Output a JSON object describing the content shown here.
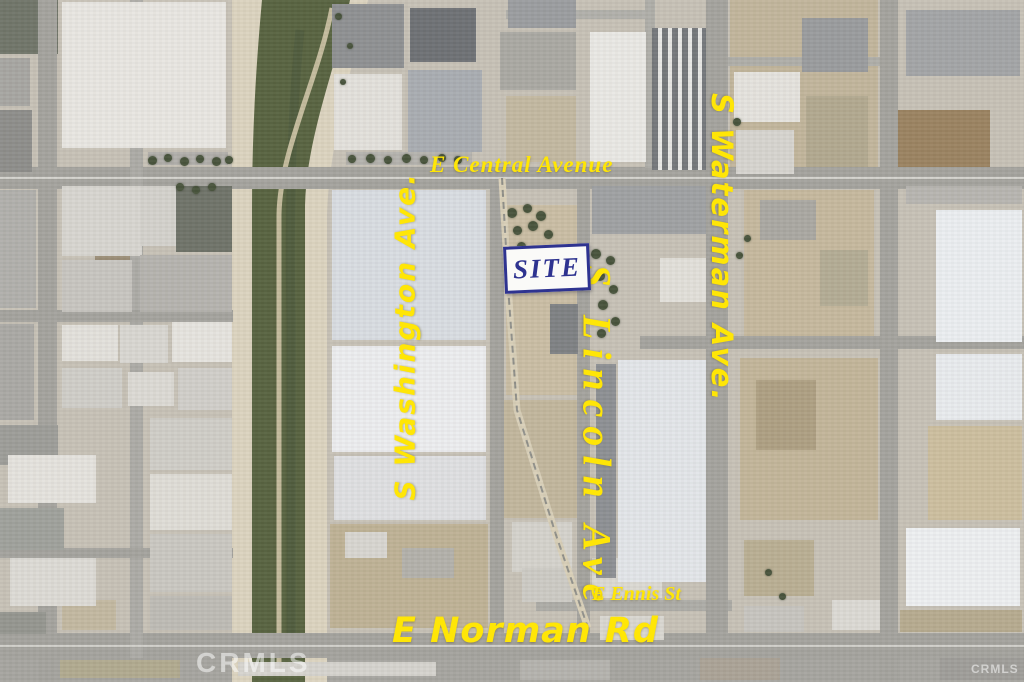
{
  "image": {
    "width": 1024,
    "height": 682,
    "kind": "aerial-satellite-map"
  },
  "labels": {
    "central": {
      "text": "E Central Avenue"
    },
    "washington": {
      "text": "S Washington Ave."
    },
    "lincoln": {
      "text": "S Lincoln Ave"
    },
    "waterman": {
      "text": "S Waterman Ave."
    },
    "ennis": {
      "text": "E Ennis St"
    },
    "norman": {
      "text": "E Norman Rd"
    },
    "site": {
      "text": "SITE"
    }
  },
  "watermarks": {
    "left": "CRMLS",
    "right": "CRMLS"
  },
  "colors": {
    "street_label": "#FFE606",
    "site_label": "#2E3390",
    "site_box_bg": "#FAFAF8",
    "watermark": "rgba(255,255,255,0.52)",
    "base_ground": "#c6c1b6",
    "road": "#a3a29d",
    "channel_sand": "#dbd3bf",
    "channel_green": "#57623f",
    "railroad": "#d8cfb8"
  },
  "map": {
    "patches": [
      [
        0,
        0,
        58,
        54,
        "#6f7468"
      ],
      [
        730,
        0,
        148,
        178,
        "#c1b59b"
      ],
      [
        506,
        96,
        70,
        66,
        "#c2b8a0"
      ],
      [
        506,
        205,
        76,
        190,
        "#c9bda3"
      ],
      [
        504,
        400,
        76,
        118,
        "#c1b69c"
      ],
      [
        330,
        524,
        158,
        104,
        "#beb195"
      ],
      [
        884,
        110,
        106,
        66,
        "#9a8260"
      ],
      [
        744,
        190,
        130,
        146,
        "#c5b89d"
      ],
      [
        740,
        358,
        138,
        162,
        "#c2b599"
      ],
      [
        756,
        380,
        60,
        70,
        "#ad9f82"
      ],
      [
        928,
        426,
        94,
        94,
        "#ccbe9e"
      ],
      [
        900,
        610,
        122,
        22,
        "#b6aa8f"
      ],
      [
        0,
        658,
        1024,
        24,
        "#a5a49f"
      ],
      [
        60,
        660,
        120,
        18,
        "#b0a98f"
      ],
      [
        62,
        600,
        54,
        30,
        "#c2b8a0"
      ],
      [
        744,
        540,
        70,
        56,
        "#b9ae93"
      ],
      [
        806,
        96,
        62,
        72,
        "#b1a88f"
      ],
      [
        820,
        250,
        48,
        56,
        "#b3ab94"
      ],
      [
        95,
        186,
        40,
        126,
        "#9a8d76"
      ]
    ],
    "roads": [
      [
        0,
        167,
        1024,
        22
      ],
      [
        0,
        633,
        1024,
        25
      ],
      [
        536,
        600,
        196,
        11,
        "#acaba6"
      ],
      [
        38,
        0,
        19,
        682
      ],
      [
        130,
        0,
        13,
        658,
        "#abaaa5"
      ],
      [
        490,
        167,
        14,
        478
      ],
      [
        577,
        167,
        13,
        478
      ],
      [
        706,
        0,
        22,
        682
      ],
      [
        880,
        0,
        18,
        682
      ],
      [
        645,
        0,
        10,
        168,
        "#aeada8"
      ],
      [
        506,
        10,
        140,
        9,
        "#b0afaa"
      ],
      [
        728,
        57,
        152,
        9,
        "#aeada8"
      ],
      [
        0,
        310,
        233,
        12
      ],
      [
        0,
        548,
        233,
        10
      ],
      [
        640,
        336,
        384,
        13
      ],
      [
        0,
        177,
        1024,
        2,
        "#d4d3ce"
      ],
      [
        0,
        645,
        1024,
        2,
        "#d0cfca"
      ]
    ],
    "buildings": [
      [
        62,
        2,
        164,
        146,
        "#e8e6e1"
      ],
      [
        148,
        152,
        80,
        13,
        "#b0aeaa"
      ],
      [
        0,
        58,
        30,
        48,
        "#a6a5a1"
      ],
      [
        0,
        110,
        32,
        62,
        "#8d8d8a"
      ],
      [
        0,
        190,
        36,
        118,
        "#b0afab"
      ],
      [
        62,
        186,
        80,
        70,
        "#d7d5d0"
      ],
      [
        140,
        186,
        40,
        60,
        "#d3d1cc"
      ],
      [
        176,
        186,
        56,
        66,
        "#6e7268"
      ],
      [
        62,
        260,
        70,
        52,
        "#c7c5c0"
      ],
      [
        140,
        255,
        92,
        57,
        "#b5b3ae"
      ],
      [
        62,
        325,
        56,
        36,
        "#e2e0db"
      ],
      [
        120,
        325,
        48,
        38,
        "#d8d6d1"
      ],
      [
        172,
        322,
        60,
        40,
        "#e5e3de"
      ],
      [
        62,
        368,
        60,
        40,
        "#cfcdc8"
      ],
      [
        128,
        372,
        46,
        34,
        "#dbd9d4"
      ],
      [
        178,
        368,
        54,
        42,
        "#d0cec9"
      ],
      [
        0,
        324,
        34,
        96,
        "#a9a8a4"
      ],
      [
        0,
        425,
        58,
        40,
        "#9c9c98"
      ],
      [
        8,
        455,
        88,
        48,
        "#e4e2dd"
      ],
      [
        0,
        508,
        64,
        42,
        "#9ea09b"
      ],
      [
        10,
        558,
        86,
        48,
        "#dcdad5"
      ],
      [
        0,
        612,
        46,
        22,
        "#94958f"
      ],
      [
        150,
        418,
        82,
        52,
        "#cfcdc7"
      ],
      [
        150,
        474,
        82,
        56,
        "#dedcd6"
      ],
      [
        150,
        534,
        82,
        58,
        "#c9c7c1"
      ],
      [
        150,
        596,
        82,
        34,
        "#bdbbb5"
      ],
      [
        332,
        4,
        72,
        64,
        "#8e9092"
      ],
      [
        410,
        8,
        66,
        54,
        "#6d7074"
      ],
      [
        334,
        74,
        68,
        76,
        "#e2e0db"
      ],
      [
        408,
        70,
        74,
        82,
        "#a8acb1"
      ],
      [
        346,
        152,
        126,
        13,
        "#b4b2ad"
      ],
      [
        332,
        190,
        154,
        150,
        "#d8dce1"
      ],
      [
        332,
        346,
        154,
        106,
        "#ecedef"
      ],
      [
        334,
        456,
        152,
        64,
        "#dedfe1"
      ],
      [
        345,
        532,
        42,
        26,
        "#d7d5d0"
      ],
      [
        402,
        548,
        52,
        30,
        "#b2b0aa"
      ],
      [
        508,
        0,
        68,
        28,
        "#9a9c9f"
      ],
      [
        500,
        32,
        76,
        58,
        "#a9a8a2"
      ],
      [
        550,
        304,
        28,
        50,
        "#7d8083"
      ],
      [
        512,
        522,
        60,
        50,
        "#d4d2cc"
      ],
      [
        522,
        568,
        50,
        34,
        "#cccac4"
      ],
      [
        592,
        558,
        70,
        40,
        "#dad8d2"
      ],
      [
        590,
        32,
        56,
        130,
        "#e9e8e4"
      ],
      [
        652,
        28,
        54,
        142,
        "#73767a",
        "striped"
      ],
      [
        592,
        186,
        114,
        48,
        "#9ea0a2"
      ],
      [
        660,
        258,
        46,
        44,
        "#e1dfd9"
      ],
      [
        596,
        364,
        20,
        214,
        "#8c8f93"
      ],
      [
        618,
        360,
        88,
        222,
        "#e2e5e9"
      ],
      [
        600,
        616,
        64,
        24,
        "#d8d6d0"
      ],
      [
        734,
        72,
        66,
        50,
        "#e4e2dd"
      ],
      [
        802,
        18,
        66,
        54,
        "#999b9d"
      ],
      [
        736,
        130,
        58,
        44,
        "#d6d4cf"
      ],
      [
        906,
        10,
        114,
        66,
        "#a2a4a6"
      ],
      [
        906,
        186,
        116,
        18,
        "#b7b5b0"
      ],
      [
        936,
        210,
        86,
        132,
        "#ebeef1"
      ],
      [
        760,
        200,
        56,
        40,
        "#a9a7a1"
      ],
      [
        936,
        354,
        86,
        66,
        "#e8ebee"
      ],
      [
        906,
        528,
        114,
        78,
        "#edeff1"
      ],
      [
        832,
        600,
        48,
        30,
        "#dbd9d4"
      ],
      [
        744,
        606,
        60,
        26,
        "#c6c4bf"
      ],
      [
        238,
        662,
        198,
        14,
        "#d5d3ce"
      ],
      [
        520,
        660,
        90,
        20,
        "#b4b2ad"
      ],
      [
        700,
        658,
        80,
        22,
        "#aaa296"
      ],
      [
        940,
        658,
        84,
        22,
        "#9e9d99"
      ]
    ],
    "trees": [
      [
        152,
        160,
        9
      ],
      [
        168,
        158,
        8
      ],
      [
        184,
        161,
        9
      ],
      [
        200,
        159,
        8
      ],
      [
        216,
        161,
        9
      ],
      [
        229,
        160,
        8
      ],
      [
        352,
        159,
        8
      ],
      [
        370,
        158,
        9
      ],
      [
        388,
        160,
        8
      ],
      [
        406,
        158,
        9
      ],
      [
        424,
        160,
        8
      ],
      [
        442,
        158,
        8
      ],
      [
        458,
        160,
        8
      ],
      [
        512,
        213,
        10
      ],
      [
        527,
        208,
        9
      ],
      [
        541,
        216,
        10
      ],
      [
        517,
        230,
        9
      ],
      [
        533,
        226,
        10
      ],
      [
        548,
        234,
        9
      ],
      [
        521,
        246,
        9
      ],
      [
        596,
        254,
        10
      ],
      [
        610,
        260,
        9
      ],
      [
        600,
        276,
        10
      ],
      [
        613,
        289,
        9
      ],
      [
        603,
        305,
        10
      ],
      [
        615,
        321,
        9
      ],
      [
        601,
        333,
        9
      ],
      [
        180,
        187,
        8
      ],
      [
        196,
        190,
        8
      ],
      [
        212,
        187,
        8
      ],
      [
        737,
        122,
        8
      ],
      [
        747,
        238,
        7
      ],
      [
        739,
        255,
        7
      ],
      [
        768,
        572,
        7
      ],
      [
        782,
        596,
        7
      ],
      [
        338,
        16,
        7
      ],
      [
        350,
        46,
        6
      ],
      [
        343,
        82,
        6
      ]
    ]
  }
}
